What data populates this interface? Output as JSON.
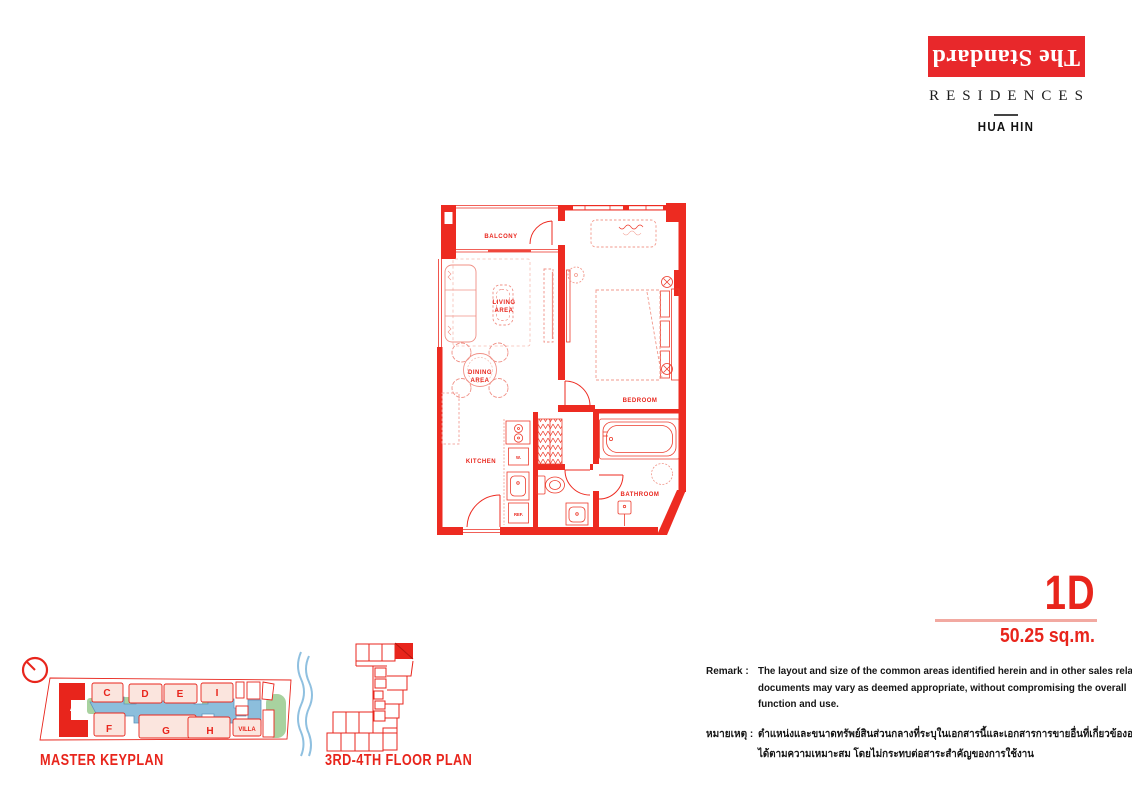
{
  "brand": {
    "name": "The Standard",
    "sub": "RESIDENCES",
    "location": "HUA HIN"
  },
  "unit": {
    "code": "1D",
    "area": "50.25 sq.m."
  },
  "plan": {
    "rooms": {
      "balcony": "BALCONY",
      "living_1": "LIVING",
      "living_2": "AREA",
      "dining_1": "DINING",
      "dining_2": "AREA",
      "kitchen": "KITCHEN",
      "bedroom": "BEDROOM",
      "bathroom": "BATHROOM"
    },
    "appliances": {
      "washer": "W.",
      "fridge": "REF."
    }
  },
  "keyplan": {
    "title": "MASTER KEYPLAN",
    "buildings": {
      "a": "A",
      "c": "C",
      "d": "D",
      "e": "E",
      "i": "I",
      "f": "F",
      "g": "G",
      "h": "H",
      "villa": "VILLA"
    }
  },
  "miniplan": {
    "title": "3RD-4TH FLOOR PLAN"
  },
  "remark": {
    "label": "Remark :",
    "lines": [
      "The layout and size of the common areas identified herein and in other sales related",
      "documents may vary as deemed appropriate, without compromising the overall",
      "function and use."
    ],
    "thai_label": "หมายเหตุ :",
    "thai_lines": [
      "ตำแหน่งและขนาดทรัพย์สินส่วนกลางที่ระบุในเอกสารนี้และเอกสารการขายอื่นที่เกี่ยวข้องอาจปรับเปลี่ยน",
      "ได้ตามความเหมาะสม โดยไม่กระทบต่อสาระสำคัญของการใช้งาน"
    ]
  },
  "colors": {
    "brand_red": "#E8251C",
    "wall_red": "#ED2B21",
    "furniture_salmon": "#F2998C",
    "underline_salmon": "#F2A9A1",
    "pool_blue": "#8CBEDC",
    "landscape_green": "#A8D29F",
    "building_pink": "#FBE5DE",
    "sea_blue": "#8FC0E0",
    "text_black": "#1A1A1A"
  }
}
